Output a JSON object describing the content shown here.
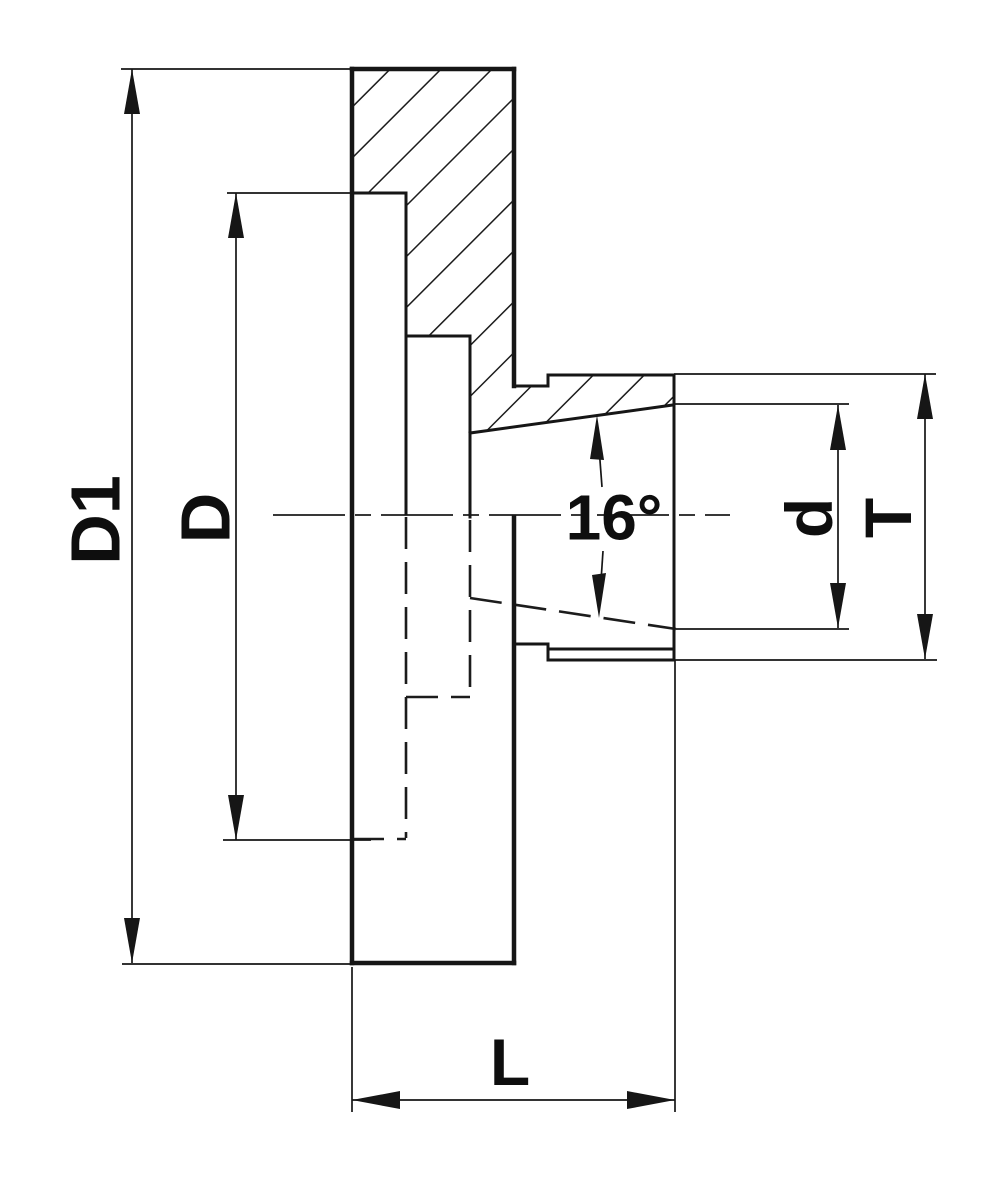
{
  "drawing": {
    "background_color": "#ffffff",
    "line_color": "#161616",
    "style": "dimensioned section drawing, hatched upper half, hidden dashed lines in lower half",
    "labels": {
      "d1": "D1",
      "d_outer": "D",
      "d_bore": "d",
      "t": "T",
      "l": "L",
      "angle": "16°"
    },
    "dimensions": [
      {
        "label": "D1",
        "orientation": "vertical",
        "measures": "full flange height (left dimension line)"
      },
      {
        "label": "D",
        "orientation": "vertical",
        "measures": "rear recess height (second left dimension line)"
      },
      {
        "label": "d",
        "orientation": "vertical",
        "measures": "taper bore mouth (right inner dimension line)"
      },
      {
        "label": "T",
        "orientation": "vertical",
        "measures": "nose outer height (right outer dimension line)"
      },
      {
        "label": "L",
        "orientation": "horizontal",
        "measures": "overall length (bottom dimension line)"
      },
      {
        "label": "16°",
        "orientation": "angular",
        "measures": "included taper angle"
      }
    ]
  }
}
